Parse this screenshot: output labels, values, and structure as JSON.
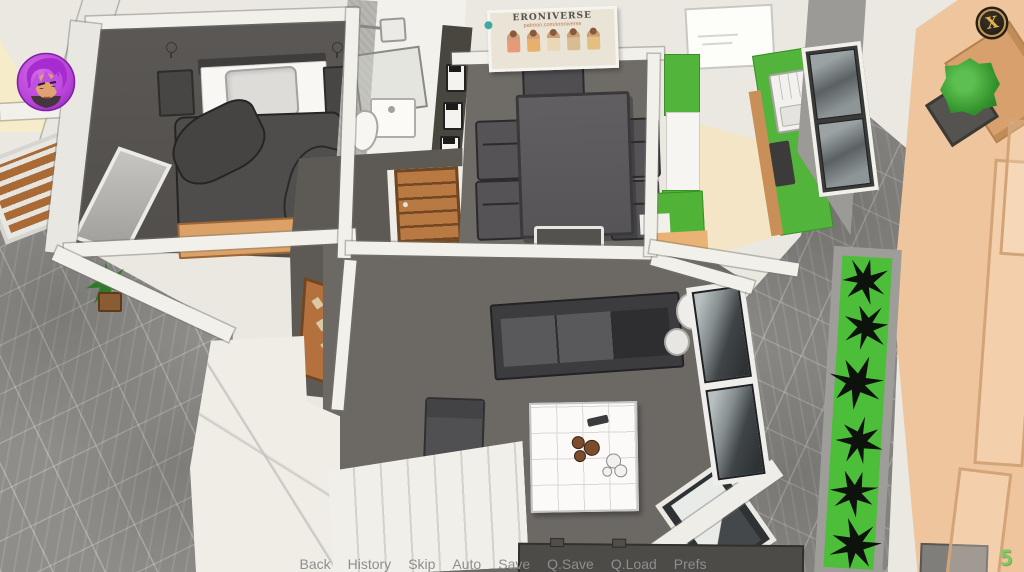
{
  "ui": {
    "quick_menu": [
      "Back",
      "History",
      "Skip",
      "Auto",
      "Save",
      "Q.Save",
      "Q.Load",
      "Prefs"
    ],
    "close_glyph": "X",
    "counter_value": "5"
  },
  "scene": {
    "poster": {
      "title": "ERONIVERSE",
      "subtitle": "patreon.com/eroniverse"
    }
  },
  "colors": {
    "kitchen_green": "#53b43b",
    "planter_green": "#4cbe3a",
    "terrace_tan": "#efc59e",
    "gold_accent": "#d9ad55",
    "avatar_purple": "#b843d8",
    "menu_text": "#8e8e8e",
    "counter_green": "#82c765"
  }
}
